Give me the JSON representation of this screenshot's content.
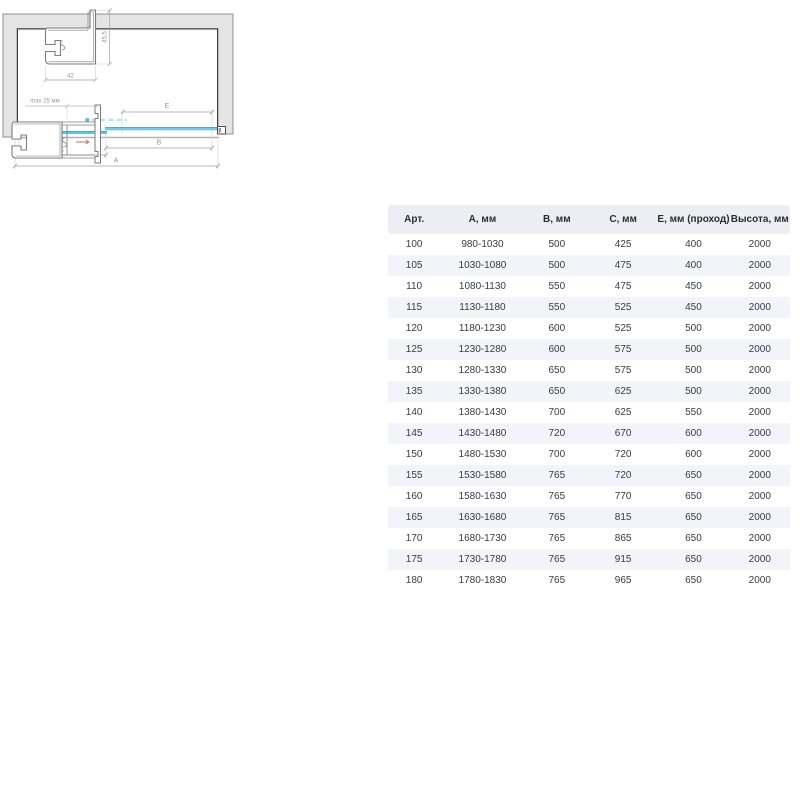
{
  "plan_view": {
    "dim_a": "A",
    "dim_b": "B",
    "dim_c": "C",
    "dim_e": "E"
  },
  "profile_top": {
    "width": "42",
    "height": "45,5"
  },
  "profile_bottom": {
    "adjustment": "max 25 мм"
  },
  "table": {
    "headers": [
      "Арт.",
      "А, мм",
      "В, мм",
      "С, мм",
      "Е, мм (проход)",
      "Высота, мм"
    ],
    "rows": [
      [
        "100",
        "980-1030",
        "500",
        "425",
        "400",
        "2000"
      ],
      [
        "105",
        "1030-1080",
        "500",
        "475",
        "400",
        "2000"
      ],
      [
        "110",
        "1080-1130",
        "550",
        "475",
        "450",
        "2000"
      ],
      [
        "115",
        "1130-1180",
        "550",
        "525",
        "450",
        "2000"
      ],
      [
        "120",
        "1180-1230",
        "600",
        "525",
        "500",
        "2000"
      ],
      [
        "125",
        "1230-1280",
        "600",
        "575",
        "500",
        "2000"
      ],
      [
        "130",
        "1280-1330",
        "650",
        "575",
        "500",
        "2000"
      ],
      [
        "135",
        "1330-1380",
        "650",
        "625",
        "500",
        "2000"
      ],
      [
        "140",
        "1380-1430",
        "700",
        "625",
        "550",
        "2000"
      ],
      [
        "145",
        "1430-1480",
        "720",
        "670",
        "600",
        "2000"
      ],
      [
        "150",
        "1480-1530",
        "700",
        "720",
        "600",
        "2000"
      ],
      [
        "155",
        "1530-1580",
        "765",
        "720",
        "650",
        "2000"
      ],
      [
        "160",
        "1580-1630",
        "765",
        "770",
        "650",
        "2000"
      ],
      [
        "165",
        "1630-1680",
        "765",
        "815",
        "650",
        "2000"
      ],
      [
        "170",
        "1680-1730",
        "765",
        "865",
        "650",
        "2000"
      ],
      [
        "175",
        "1730-1780",
        "765",
        "915",
        "650",
        "2000"
      ],
      [
        "180",
        "1780-1830",
        "765",
        "965",
        "650",
        "2000"
      ]
    ]
  },
  "colors": {
    "glass": "#5fc8e8",
    "glass_edge_dark": "#35809e",
    "glass_dashed": "#b7e4f3",
    "wall_fill": "#e4e4e4",
    "wall_border": "#8f8f8f",
    "frame": "#3f3f3f",
    "dimension_line": "#a3a3a3",
    "dimension_text": "#93989e",
    "profile_stroke": "#7c7c7c",
    "arrow_red": "#c96b6b",
    "table_header_bg": "#eceef4",
    "table_alt_row_bg": "#f3f4f9",
    "table_text": "#3a3a44"
  }
}
